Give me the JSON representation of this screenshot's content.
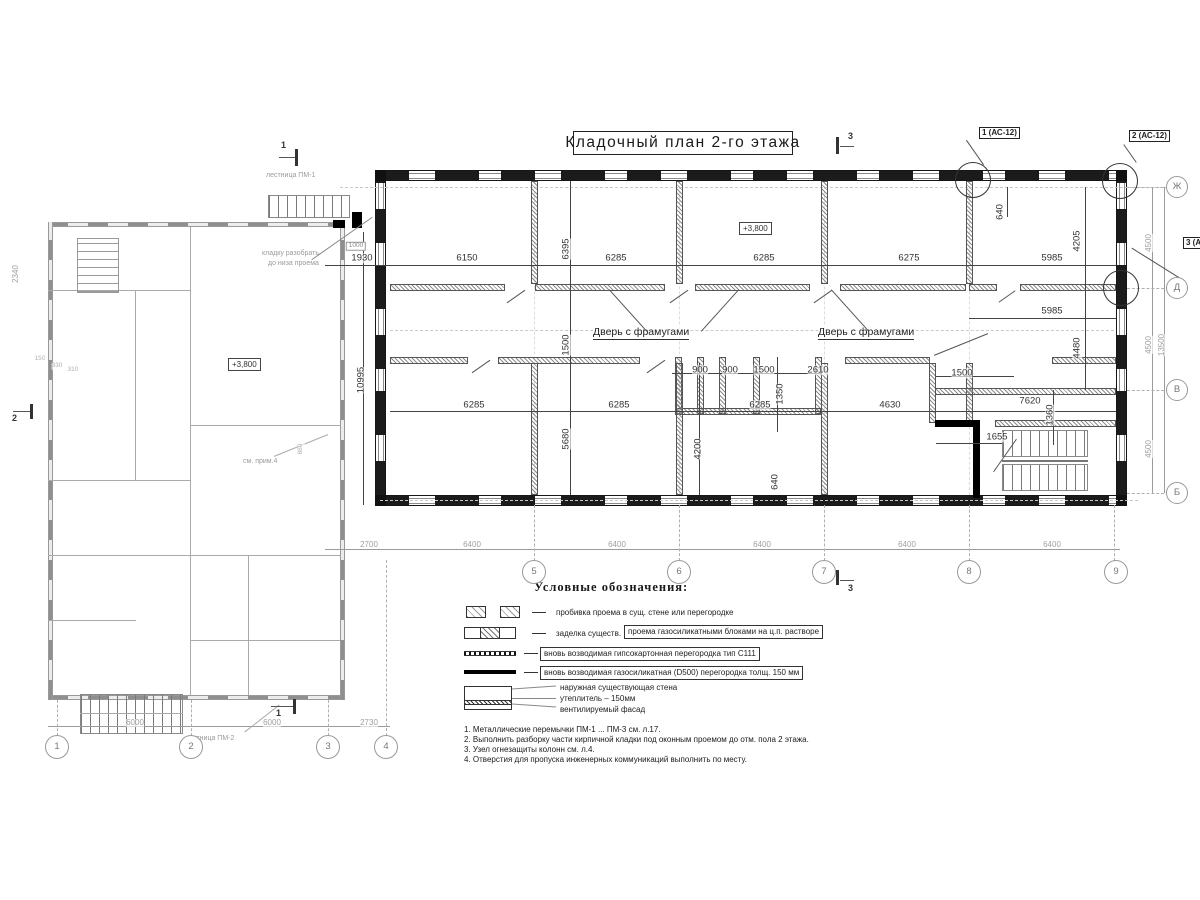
{
  "title": "Кладочный план 2-го этажа",
  "levels": {
    "left": "+3,800",
    "main": "+3,800"
  },
  "callouts": {
    "c1": "1 (АС-12)",
    "c2": "2 (АС-12)",
    "c3": "3 (АС-12)"
  },
  "sections": {
    "s1": "1",
    "s2": "2",
    "s3": "3"
  },
  "labels": {
    "door1": "Дверь с фрамугами",
    "door2": "Дверь с фрамугами",
    "stair_top": "лестница ПМ-1",
    "stair_bottom": "лестница ПМ-2",
    "dismantle_line1": "кладку разобрать",
    "dismantle_line2": "до низа проема",
    "see_note": "см. прим.4"
  },
  "legend": {
    "title": "Условные обозначения:",
    "item1": "пробивка проема  в сущ. стене  или перегородке",
    "item2_plain": "заделка существ.",
    "item2_boxed": "проема газосиликатными блоками на ц.п. растворе",
    "item3": "вновь возводимая гипсокартонная перегородка тип С111",
    "item4": "вновь возводимая газосиликатная (D500) перегородка толщ. 150 мм",
    "item5_line1": "наружная существующая стена",
    "item5_line2": "утеплитель – 150мм",
    "item5_line3": "вентилируемый фасад"
  },
  "notes": [
    "1. Металлические перемычки  ПМ-1 ... ПМ-3 см. л.17.",
    "2. Выполнить разборку части кирпичной кладки под оконным проемом до отм. пола 2 этажа.",
    "3. Узел огнезащиты колонн см. л.4.",
    "4. Отверстия для пропуска инженерных коммуникаций выполнить по месту."
  ],
  "axes": {
    "bottom_main": [
      "5",
      "6",
      "7",
      "8",
      "9"
    ],
    "bottom_left": [
      "1",
      "2",
      "3",
      "4"
    ],
    "right": [
      "Ж",
      "Д",
      "В",
      "Б"
    ]
  },
  "axis_circles": [
    {
      "t": "5",
      "x": 534,
      "y": 572,
      "r": 11
    },
    {
      "t": "6",
      "x": 679,
      "y": 572,
      "r": 11
    },
    {
      "t": "7",
      "x": 824,
      "y": 572,
      "r": 11
    },
    {
      "t": "8",
      "x": 969,
      "y": 572,
      "r": 11
    },
    {
      "t": "9",
      "x": 1116,
      "y": 572,
      "r": 11
    },
    {
      "t": "1",
      "x": 57,
      "y": 747,
      "r": 11
    },
    {
      "t": "2",
      "x": 191,
      "y": 747,
      "r": 11
    },
    {
      "t": "3",
      "x": 328,
      "y": 747,
      "r": 11
    },
    {
      "t": "4",
      "x": 386,
      "y": 747,
      "r": 11
    },
    {
      "t": "Ж",
      "x": 1177,
      "y": 187,
      "r": 10
    },
    {
      "t": "Д",
      "x": 1177,
      "y": 288,
      "r": 10
    },
    {
      "t": "В",
      "x": 1177,
      "y": 390,
      "r": 10
    },
    {
      "t": "Б",
      "x": 1177,
      "y": 493,
      "r": 10
    }
  ],
  "dims": [
    {
      "t": "1930",
      "x": 362,
      "y": 258
    },
    {
      "t": "6150",
      "x": 467,
      "y": 258
    },
    {
      "t": "6285",
      "x": 616,
      "y": 258
    },
    {
      "t": "6285",
      "x": 764,
      "y": 258
    },
    {
      "t": "6275",
      "x": 909,
      "y": 258
    },
    {
      "t": "5985",
      "x": 1052,
      "y": 258
    },
    {
      "t": "5985",
      "x": 1052,
      "y": 311
    },
    {
      "t": "6395",
      "x": 566,
      "y": 249,
      "r": 1
    },
    {
      "t": "1500",
      "x": 566,
      "y": 345,
      "r": 1
    },
    {
      "t": "10995",
      "x": 361,
      "y": 380,
      "r": 1
    },
    {
      "t": "640",
      "x": 1000,
      "y": 212,
      "r": 1
    },
    {
      "t": "4205",
      "x": 1077,
      "y": 241,
      "r": 1
    },
    {
      "t": "4480",
      "x": 1077,
      "y": 348,
      "r": 1
    },
    {
      "t": "5680",
      "x": 566,
      "y": 439,
      "r": 1
    },
    {
      "t": "4200",
      "x": 698,
      "y": 449,
      "r": 1
    },
    {
      "t": "640",
      "x": 775,
      "y": 482,
      "r": 1
    },
    {
      "t": "900",
      "x": 700,
      "y": 370
    },
    {
      "t": "900",
      "x": 730,
      "y": 370
    },
    {
      "t": "1500",
      "x": 764,
      "y": 370
    },
    {
      "t": "1350",
      "x": 780,
      "y": 394,
      "r": 1
    },
    {
      "t": "2610",
      "x": 818,
      "y": 370
    },
    {
      "t": "1500",
      "x": 962,
      "y": 373
    },
    {
      "t": "6285",
      "x": 474,
      "y": 405
    },
    {
      "t": "6285",
      "x": 619,
      "y": 405
    },
    {
      "t": "6285",
      "x": 760,
      "y": 405
    },
    {
      "t": "4630",
      "x": 890,
      "y": 405
    },
    {
      "t": "7620",
      "x": 1030,
      "y": 401
    },
    {
      "t": "1360",
      "x": 1050,
      "y": 415,
      "r": 1
    },
    {
      "t": "1655",
      "x": 997,
      "y": 437
    },
    {
      "t": "2700",
      "x": 369,
      "y": 545,
      "c": "g"
    },
    {
      "t": "6400",
      "x": 472,
      "y": 545,
      "c": "g"
    },
    {
      "t": "6400",
      "x": 617,
      "y": 545,
      "c": "g"
    },
    {
      "t": "6400",
      "x": 762,
      "y": 545,
      "c": "g"
    },
    {
      "t": "6400",
      "x": 907,
      "y": 545,
      "c": "g"
    },
    {
      "t": "6400",
      "x": 1052,
      "y": 545,
      "c": "g"
    },
    {
      "t": "6000",
      "x": 135,
      "y": 723,
      "c": "g"
    },
    {
      "t": "6000",
      "x": 272,
      "y": 723,
      "c": "g"
    },
    {
      "t": "2730",
      "x": 369,
      "y": 723,
      "c": "g"
    },
    {
      "t": "4500",
      "x": 1149,
      "y": 243,
      "r": 1,
      "c": "g"
    },
    {
      "t": "4500",
      "x": 1149,
      "y": 345,
      "r": 1,
      "c": "g"
    },
    {
      "t": "13500",
      "x": 1162,
      "y": 345,
      "r": 1,
      "c": "g"
    },
    {
      "t": "4500",
      "x": 1149,
      "y": 449,
      "r": 1,
      "c": "g"
    },
    {
      "t": "2340",
      "x": 16,
      "y": 274,
      "r": 1,
      "c": "g"
    },
    {
      "t": "880",
      "x": 301,
      "y": 449,
      "r": 1,
      "c": "t"
    },
    {
      "t": "150",
      "x": 40,
      "y": 359,
      "c": "t"
    },
    {
      "t": "330",
      "x": 57,
      "y": 366,
      "c": "t"
    },
    {
      "t": "310",
      "x": 73,
      "y": 370,
      "c": "t"
    },
    {
      "t": "1000",
      "x": 356,
      "y": 246,
      "c": "b"
    }
  ]
}
